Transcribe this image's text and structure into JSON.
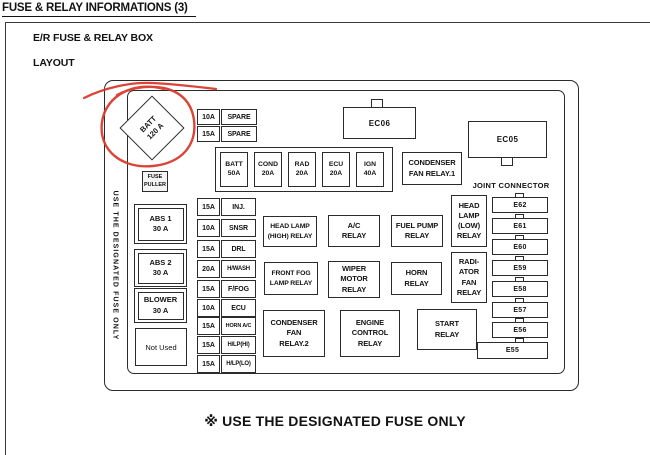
{
  "page": {
    "title": "FUSE & RELAY INFORMATIONS (3)",
    "box_title": "E/R FUSE & RELAY BOX",
    "section_label": "LAYOUT",
    "footer_note": "※ USE THE DESIGNATED FUSE ONLY"
  },
  "colors": {
    "line": "#2b2b2b",
    "annotation_red": "#d93a2b"
  },
  "diagram": {
    "rim_note": "USE THE DESIGNATED FUSE ONLY",
    "battery_fuse": "BATT\n120 A",
    "fuse_puller": "FUSE\nPULLER",
    "spare_fuses": [
      {
        "amp": "10A",
        "label": "SPARE"
      },
      {
        "amp": "15A",
        "label": "SPARE"
      }
    ],
    "main_fuse_strip": [
      "BATT\n50A",
      "COND\n20A",
      "RAD\n20A",
      "ECU\n20A",
      "IGN\n40A"
    ],
    "left_column": [
      "ABS 1\n30 A",
      "ABS 2\n30 A",
      "BLOWER\n30 A",
      "Not Used"
    ],
    "fuse_list": [
      {
        "amp": "15A",
        "label": "INJ."
      },
      {
        "amp": "10A",
        "label": "SNSR"
      },
      {
        "amp": "15A",
        "label": "DRL"
      },
      {
        "amp": "20A",
        "label": "H/WASH"
      },
      {
        "amp": "15A",
        "label": "F/FOG"
      },
      {
        "amp": "10A",
        "label": "ECU"
      },
      {
        "amp": "15A",
        "label": "HORN A/C"
      },
      {
        "amp": "15A",
        "label": "H/LP(HI)"
      },
      {
        "amp": "15A",
        "label": "H/LP(LO)"
      }
    ],
    "connectors": {
      "ec06": "EC06",
      "ec05": "EC05"
    },
    "joint_connector": {
      "label": "JOINT CONNECTOR",
      "items": [
        "E62",
        "E61",
        "E60",
        "E59",
        "E58",
        "E57",
        "E56",
        "E55"
      ]
    },
    "relays": {
      "condenser_fan_1": "CONDENSER\nFAN RELAY.1",
      "head_lamp_high": "HEAD LAMP\n(HIGH) RELAY",
      "ac": "A/C\nRELAY",
      "fuel_pump": "FUEL PUMP\nRELAY",
      "head_lamp_low": "HEAD\nLAMP\n(LOW)\nRELAY",
      "front_fog": "FRONT FOG\nLAMP RELAY",
      "wiper_motor": "WIPER\nMOTOR\nRELAY",
      "horn": "HORN\nRELAY",
      "radiator_fan": "RADI-\nATOR\nFAN\nRELAY",
      "condenser_fan_2": "CONDENSER\nFAN\nRELAY.2",
      "engine_control": "ENGINE\nCONTROL\nRELAY",
      "start": "START\nRELAY"
    }
  }
}
